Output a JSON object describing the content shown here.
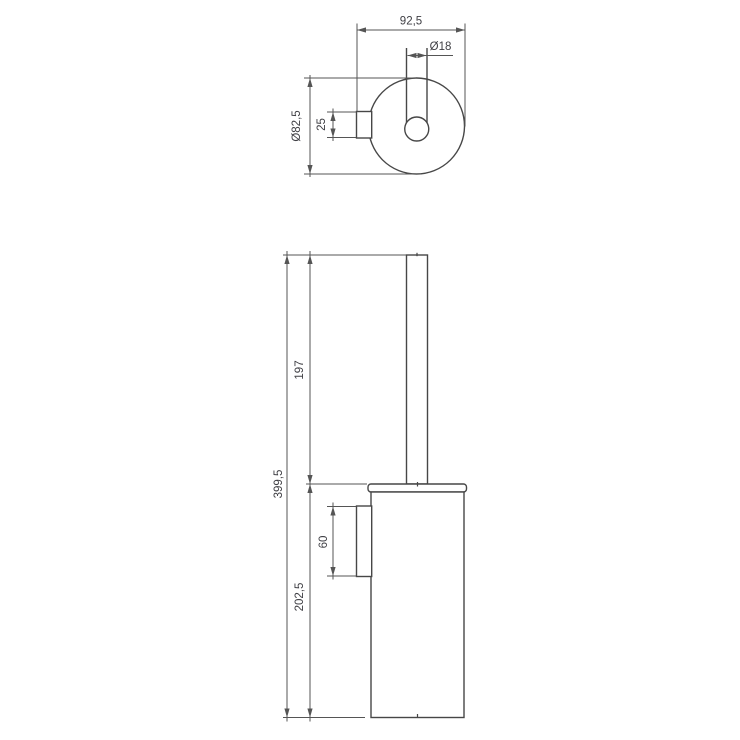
{
  "top_view": {
    "dim_depth": "92,5",
    "dim_handle_diameter": "Ø18",
    "dim_holder_diameter": "Ø82,5",
    "dim_mount_plate_width": "25"
  },
  "front_view": {
    "dim_total_height": "399,5",
    "dim_handle_length": "197",
    "dim_container_height": "202,5",
    "dim_mount_plate_height": "60"
  },
  "colors": {
    "background": "#ffffff",
    "object_line": "#474747",
    "dimension_line": "#555555",
    "text": "#3f3f44"
  }
}
